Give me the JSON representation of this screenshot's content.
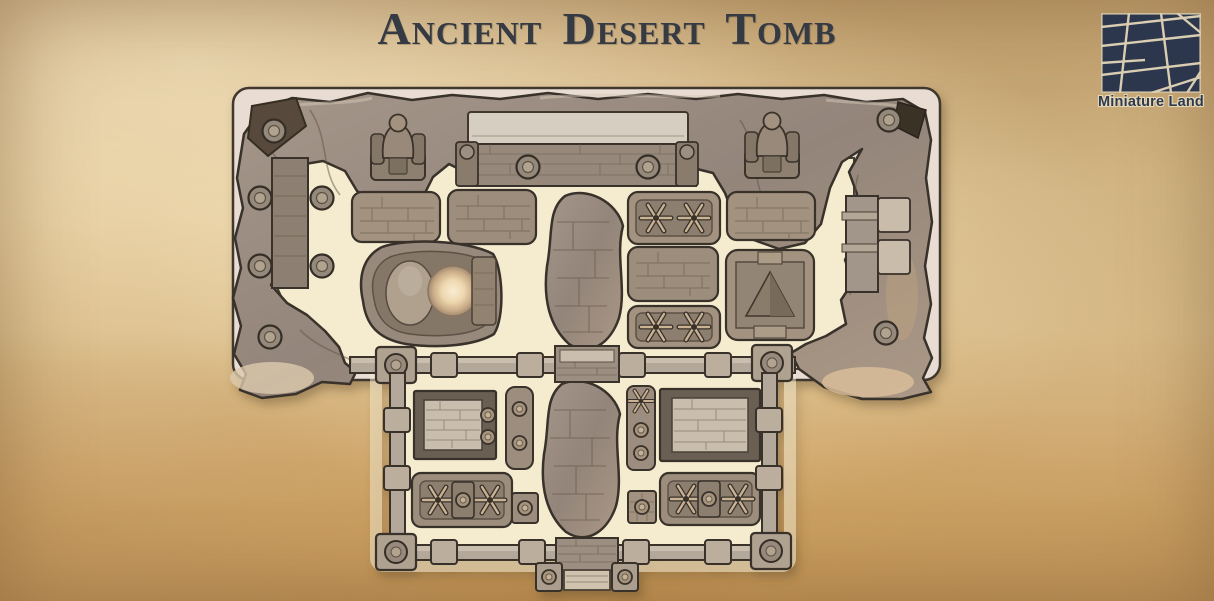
{
  "title": "Ancient Desert Tomb",
  "logo": {
    "brand": "Miniature Land"
  },
  "colors": {
    "parchment_background": "#d9ba88",
    "title_text": "#353a43",
    "logo_navy": "#2c374d",
    "logo_lines": "#d9cdb2",
    "plate": "#e9dcd2",
    "floor_cream": "#f5ecd0",
    "stone_grey": "#9a8b7c",
    "outline_ink": "#39302a",
    "glow_orb": "#f9ecd2",
    "spike_tan": "#c9b393"
  },
  "map_features": [
    "rock-canyon-walls",
    "grand-entrance-gate",
    "pharaoh-statue-left",
    "pharaoh-statue-right",
    "sarcophagus-pit-with-glowing-orb",
    "spike-trap-platforms",
    "pyramid-altar-platform",
    "brick-floor-chambers",
    "rubble-divider-walls",
    "pillared-courtyard-walls",
    "courtyard-gate-with-steps",
    "brazier-stands"
  ]
}
